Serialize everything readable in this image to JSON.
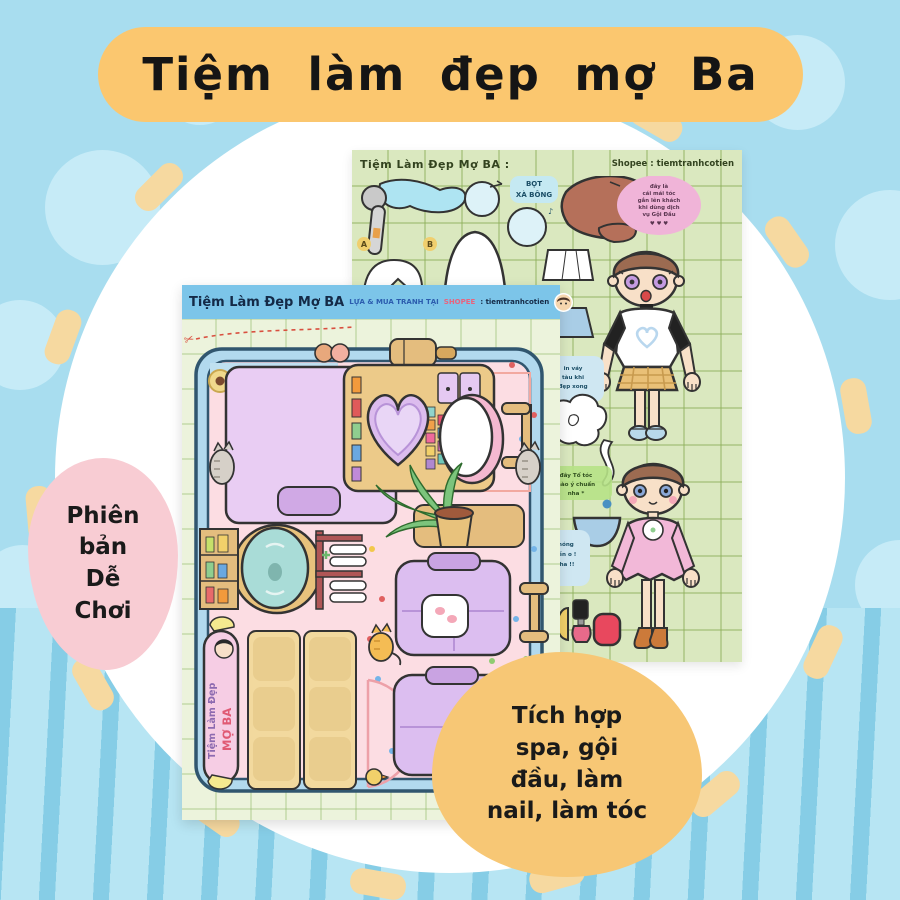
{
  "banner": {
    "text": "Tiệm làm đẹp mợ Ba"
  },
  "badge_left": {
    "lines": [
      "Phiên",
      "bản",
      "Dễ",
      "Chơi"
    ]
  },
  "badge_right": {
    "lines": [
      "Tích hợp",
      "spa, gội",
      "đầu, làm",
      "nail, làm tóc"
    ]
  },
  "back_sheet": {
    "title": "Tiệm Làm Đẹp Mợ BA :",
    "shop": "Shopee : tiemtranhcotien",
    "foam_label": [
      "BỌT",
      "XÀ BÔNG"
    ],
    "marker_a": "A",
    "marker_b": "B",
    "pink_note": [
      "đây là",
      "cái mái tóc",
      "gắn lên khách",
      "khi dùng dịch",
      "vụ Gội Đầu",
      "♥ ♥ ♥"
    ],
    "blue_note_1": [
      "in váy",
      "tàu khi",
      "đẹp xong"
    ],
    "green_note": [
      "đây Tổ tóc",
      "nào ý chuẩn",
      "nha *"
    ],
    "blue_note_2": [
      "móng",
      "tiền o !",
      "nha !!"
    ]
  },
  "front_sheet": {
    "title": "Tiệm Làm Đẹp Mợ BA",
    "buy_text": "LỰA & MUA TRANH TẠI",
    "shop_brand": "SHOPEE",
    "shop_name": ": tiemtranhcotien",
    "scissors": "✂",
    "side_banner_top": "Tiệm Làm Đẹp",
    "side_banner_bottom": "MỢ BA"
  },
  "colors": {
    "background": "#a8ddef",
    "background_dots": "#c6ebf7",
    "stripe_dark": "#86cde6",
    "circle": "#ffffff",
    "dash_ring": "#f6d9a0",
    "title_banner": "#fbc76f",
    "badge_pink": "#f8ccd3",
    "badge_yellow": "#f7c775",
    "back_sheet_paper": "#dae8bf",
    "front_sheet_paper": "#ecf3dc",
    "front_header_bar": "#7cc5e9",
    "room_floor": "#fcdde3",
    "room_border": "#b2d9ee",
    "lavender": "#e9cdf3",
    "tan": "#ecca89",
    "shopee_accent": "#e8647e"
  }
}
